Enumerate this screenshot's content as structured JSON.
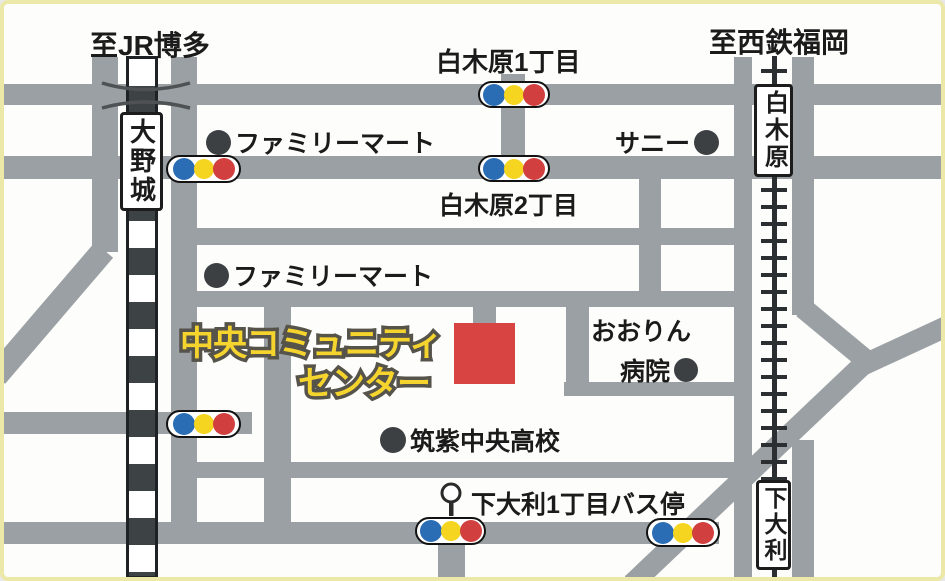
{
  "destinations": {
    "jr_hakata": "至JR博多",
    "nishitetsu_fukuoka": "至西鉄福岡"
  },
  "intersections": {
    "shirakibaru_1chome": "白木原1丁目",
    "shirakibaru_2chome": "白木原2丁目"
  },
  "stations": {
    "onojo": "大野城",
    "shirakibaru": "白木原",
    "shimoori": "下大利"
  },
  "landmarks": {
    "familymart_1": "ファミリーマート",
    "familymart_2": "ファミリーマート",
    "sunny": "サニー",
    "hospital_line1": "おおりん",
    "hospital_line2": "病院",
    "school": "筑紫中央高校",
    "bus_stop": "下大利1丁目バス停"
  },
  "center": {
    "line1": "中央コミュニティ",
    "line2": "センター"
  },
  "colors": {
    "road_gray": "#9aa0a3",
    "signal_blue": "#2a6db5",
    "signal_yellow": "#f5d51f",
    "signal_red": "#d23f3f",
    "marker_red": "#d84442",
    "title_yellow": "#f6d42e",
    "border_yellow": "#ece9a8",
    "landmark_dot": "#3c4043"
  }
}
